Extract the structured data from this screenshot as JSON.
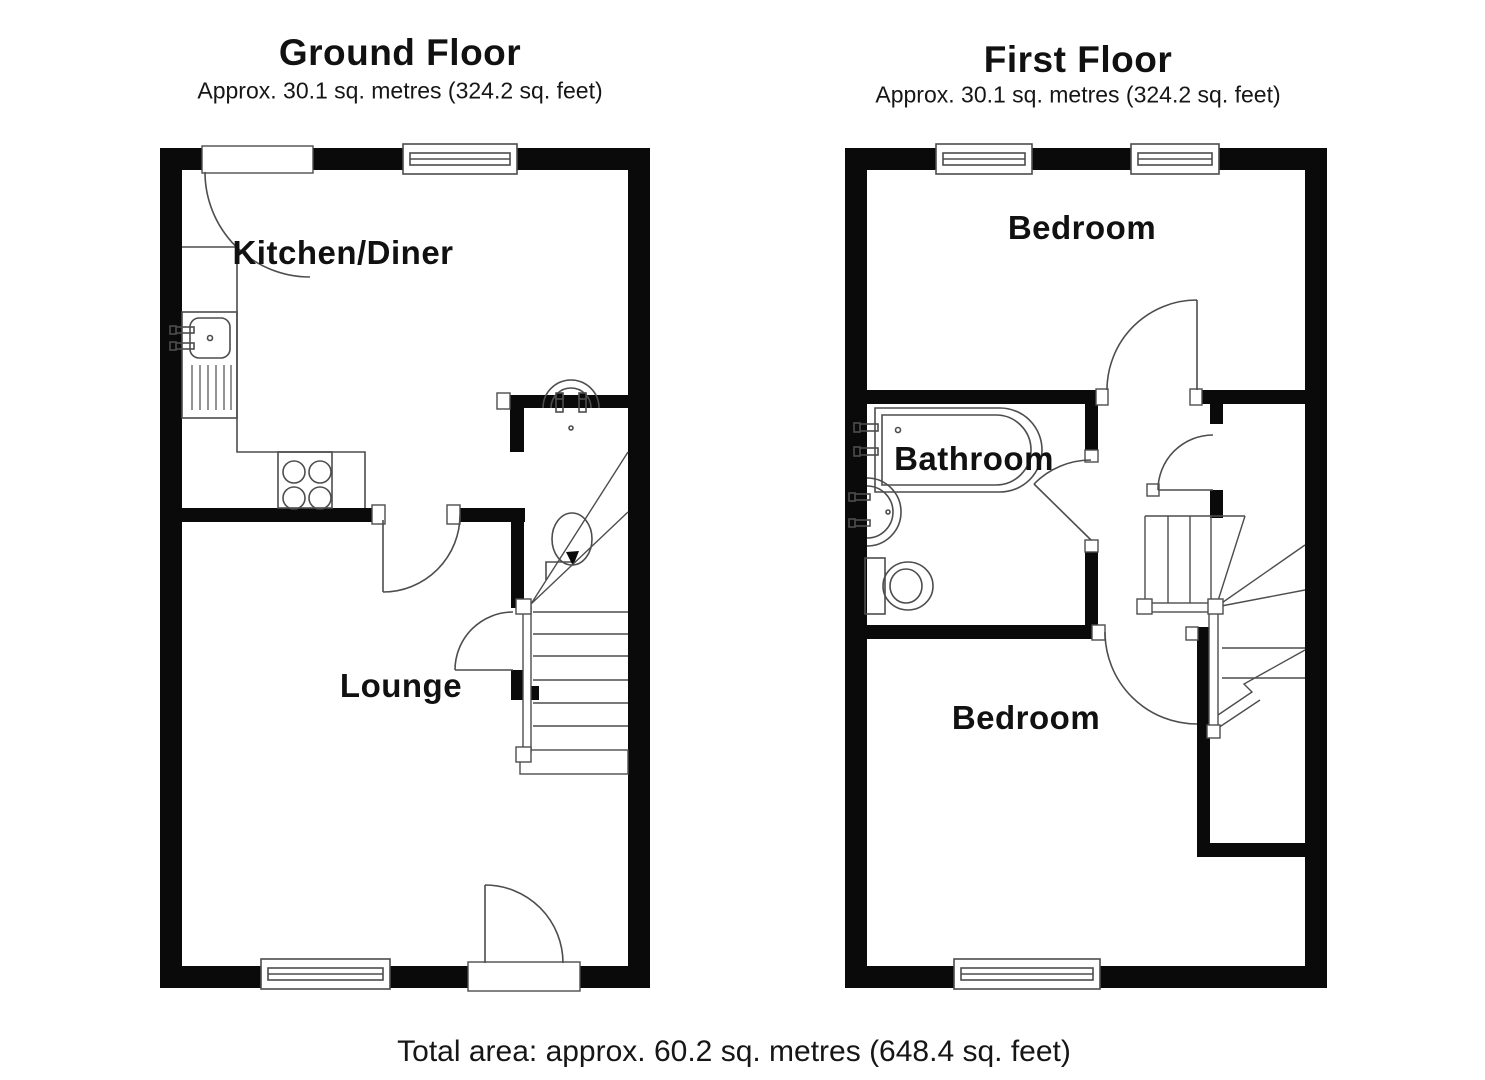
{
  "ground_floor": {
    "title": "Ground Floor",
    "area": "Approx. 30.1 sq. metres (324.2 sq. feet)",
    "rooms": {
      "kitchen": "Kitchen/Diner",
      "lounge": "Lounge"
    }
  },
  "first_floor": {
    "title": "First Floor",
    "area": "Approx. 30.1 sq. metres (324.2 sq. feet)",
    "rooms": {
      "bedroom_front": "Bedroom",
      "bathroom": "Bathroom",
      "bedroom_back": "Bedroom"
    }
  },
  "footer": {
    "total_area": "Total area: approx. 60.2 sq. metres (648.4 sq. feet)"
  },
  "colors": {
    "wall": "#0a0a0a",
    "line": "#4d4d4d",
    "background": "#ffffff",
    "text": "#111111"
  }
}
